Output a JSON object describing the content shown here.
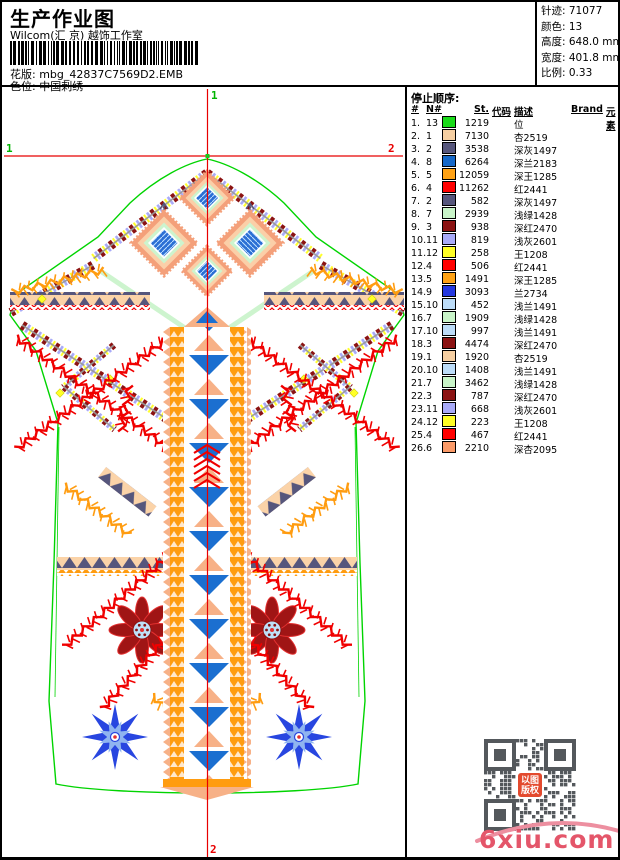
{
  "page": {
    "title": "生产作业图",
    "studio": "Wilcom(汇 京) 越饰工作室",
    "pattern_label": "花版:",
    "pattern_value": "mbg_42837C7569D2.EMB",
    "colorway_label": "色位:",
    "colorway_value": "中国刺绣"
  },
  "info_panel": {
    "items": [
      {
        "label": "针迹:",
        "value": "71077"
      },
      {
        "label": "颜色:",
        "value": "13"
      },
      {
        "label": "高度:",
        "value": "648.0 mm"
      },
      {
        "label": "宽度:",
        "value": "401.8 mm"
      },
      {
        "label": "比例:",
        "value": "0.33"
      }
    ]
  },
  "stop_sequence": {
    "title": "停止顺序:",
    "columns": [
      "#",
      "N#",
      "St.",
      "代码",
      "描述",
      "Brand",
      "元素"
    ],
    "rows": [
      {
        "idx": "1.",
        "n": "13",
        "color": "#1ADB1A",
        "st": "1219",
        "code": "",
        "desc": "位",
        "brand": "",
        "element": ""
      },
      {
        "idx": "2.",
        "n": "1",
        "color": "#F6CFA2",
        "st": "7130",
        "code": "",
        "desc": "杏2519",
        "brand": "",
        "element": ""
      },
      {
        "idx": "3.",
        "n": "2",
        "color": "#56567C",
        "st": "3538",
        "code": "",
        "desc": "深灰1497",
        "brand": "",
        "element": ""
      },
      {
        "idx": "4.",
        "n": "8",
        "color": "#1668C8",
        "st": "6264",
        "code": "",
        "desc": "深兰2183",
        "brand": "",
        "element": ""
      },
      {
        "idx": "5.",
        "n": "5",
        "color": "#FFA215",
        "st": "12059",
        "code": "",
        "desc": "深王1285",
        "brand": "",
        "element": ""
      },
      {
        "idx": "6.",
        "n": "4",
        "color": "#FF0000",
        "st": "11262",
        "code": "",
        "desc": "红2441",
        "brand": "",
        "element": ""
      },
      {
        "idx": "7.",
        "n": "2",
        "color": "#56567C",
        "st": "582",
        "code": "",
        "desc": "深灰1497",
        "brand": "",
        "element": ""
      },
      {
        "idx": "8.",
        "n": "7",
        "color": "#C9F5C9",
        "st": "2939",
        "code": "",
        "desc": "浅绿1428",
        "brand": "",
        "element": ""
      },
      {
        "idx": "9.",
        "n": "3",
        "color": "#8B1212",
        "st": "938",
        "code": "",
        "desc": "深红2470",
        "brand": "",
        "element": ""
      },
      {
        "idx": "10.",
        "n": "11",
        "color": "#A8AAF8",
        "st": "819",
        "code": "",
        "desc": "浅灰2601",
        "brand": "",
        "element": ""
      },
      {
        "idx": "11.",
        "n": "12",
        "color": "#FFFF26",
        "st": "258",
        "code": "",
        "desc": "王1208",
        "brand": "",
        "element": ""
      },
      {
        "idx": "12.",
        "n": "4",
        "color": "#FF0000",
        "st": "506",
        "code": "",
        "desc": "红2441",
        "brand": "",
        "element": ""
      },
      {
        "idx": "13.",
        "n": "5",
        "color": "#FFA215",
        "st": "1491",
        "code": "",
        "desc": "深王1285",
        "brand": "",
        "element": ""
      },
      {
        "idx": "14.",
        "n": "9",
        "color": "#2438E0",
        "st": "3093",
        "code": "",
        "desc": "兰2734",
        "brand": "",
        "element": ""
      },
      {
        "idx": "15.",
        "n": "10",
        "color": "#BCDCF8",
        "st": "452",
        "code": "",
        "desc": "浅兰1491",
        "brand": "",
        "element": ""
      },
      {
        "idx": "16.",
        "n": "7",
        "color": "#C9F5C9",
        "st": "1909",
        "code": "",
        "desc": "浅绿1428",
        "brand": "",
        "element": ""
      },
      {
        "idx": "17.",
        "n": "10",
        "color": "#BCDCF8",
        "st": "997",
        "code": "",
        "desc": "浅兰1491",
        "brand": "",
        "element": ""
      },
      {
        "idx": "18.",
        "n": "3",
        "color": "#8B1212",
        "st": "4474",
        "code": "",
        "desc": "深红2470",
        "brand": "",
        "element": ""
      },
      {
        "idx": "19.",
        "n": "1",
        "color": "#F6CFA2",
        "st": "1920",
        "code": "",
        "desc": "杏2519",
        "brand": "",
        "element": ""
      },
      {
        "idx": "20.",
        "n": "10",
        "color": "#BCDCF8",
        "st": "1408",
        "code": "",
        "desc": "浅兰1491",
        "brand": "",
        "element": ""
      },
      {
        "idx": "21.",
        "n": "7",
        "color": "#C9F5C9",
        "st": "3462",
        "code": "",
        "desc": "浅绿1428",
        "brand": "",
        "element": ""
      },
      {
        "idx": "22.",
        "n": "3",
        "color": "#8B1212",
        "st": "787",
        "code": "",
        "desc": "深红2470",
        "brand": "",
        "element": ""
      },
      {
        "idx": "23.",
        "n": "11",
        "color": "#A8AAF8",
        "st": "668",
        "code": "",
        "desc": "浅灰2601",
        "brand": "",
        "element": ""
      },
      {
        "idx": "24.",
        "n": "12",
        "color": "#FFFF26",
        "st": "223",
        "code": "",
        "desc": "王1208",
        "brand": "",
        "element": ""
      },
      {
        "idx": "25.",
        "n": "4",
        "color": "#FF0000",
        "st": "467",
        "code": "",
        "desc": "红2441",
        "brand": "",
        "element": ""
      },
      {
        "idx": "26.",
        "n": "6",
        "color": "#FB9A68",
        "st": "2210",
        "code": "",
        "desc": "深杏2095",
        "brand": "",
        "element": ""
      }
    ]
  },
  "design": {
    "markers": {
      "top": "1",
      "left": "1",
      "right": "2",
      "bottom": "2"
    }
  },
  "watermark": {
    "qr_logo_line1": "以图",
    "qr_logo_line2": "版权",
    "site": "6xiu.com",
    "site_color": "#E4566A"
  },
  "palette": {
    "outline_green": "#00D400",
    "crosshair_red": "#E80000",
    "slate": "#56567C",
    "orange": "#FF9C10",
    "peach": "#F7B187",
    "salmon": "#F4A07A",
    "light_green": "#CDF4CE",
    "blue": "#1B6FD0",
    "royal_blue": "#2438E0",
    "light_blue": "#BEE0F8",
    "lavender": "#A8AAF8",
    "yellow": "#FFFF26",
    "dark_red": "#8B1212",
    "red": "#FF0000"
  }
}
